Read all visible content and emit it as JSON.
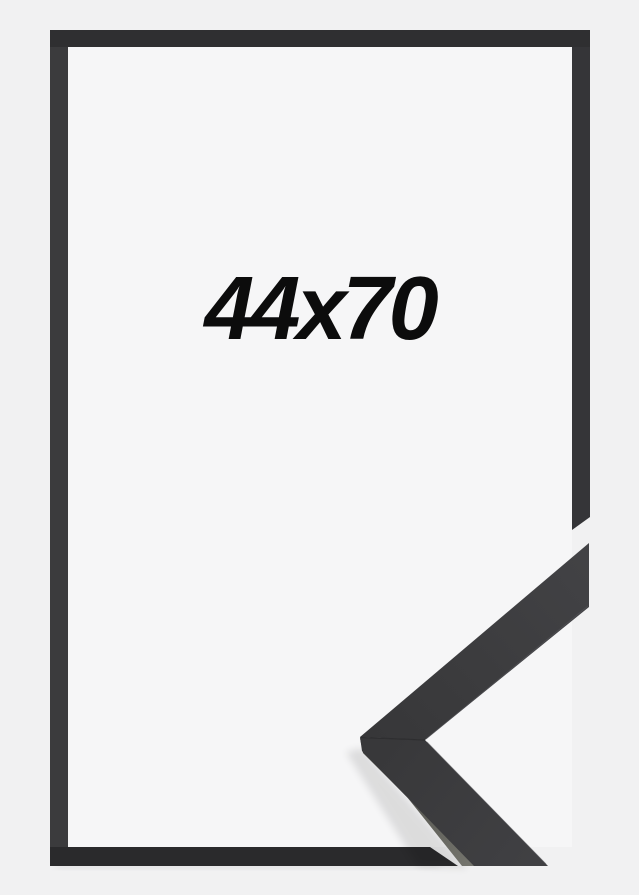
{
  "product": {
    "size_label": "44x70"
  },
  "colors": {
    "background_outer": "#f1f1f2",
    "background_inner": "#f6f6f7",
    "frame_top_bar": "#2f2f31",
    "frame_left_bar": "#3b3b3d",
    "frame_right_bar": "#353538",
    "frame_bottom_bar": "#2a2a2c",
    "corner_seam": "#2c2c2e",
    "label_text": "#0c0c0c"
  }
}
